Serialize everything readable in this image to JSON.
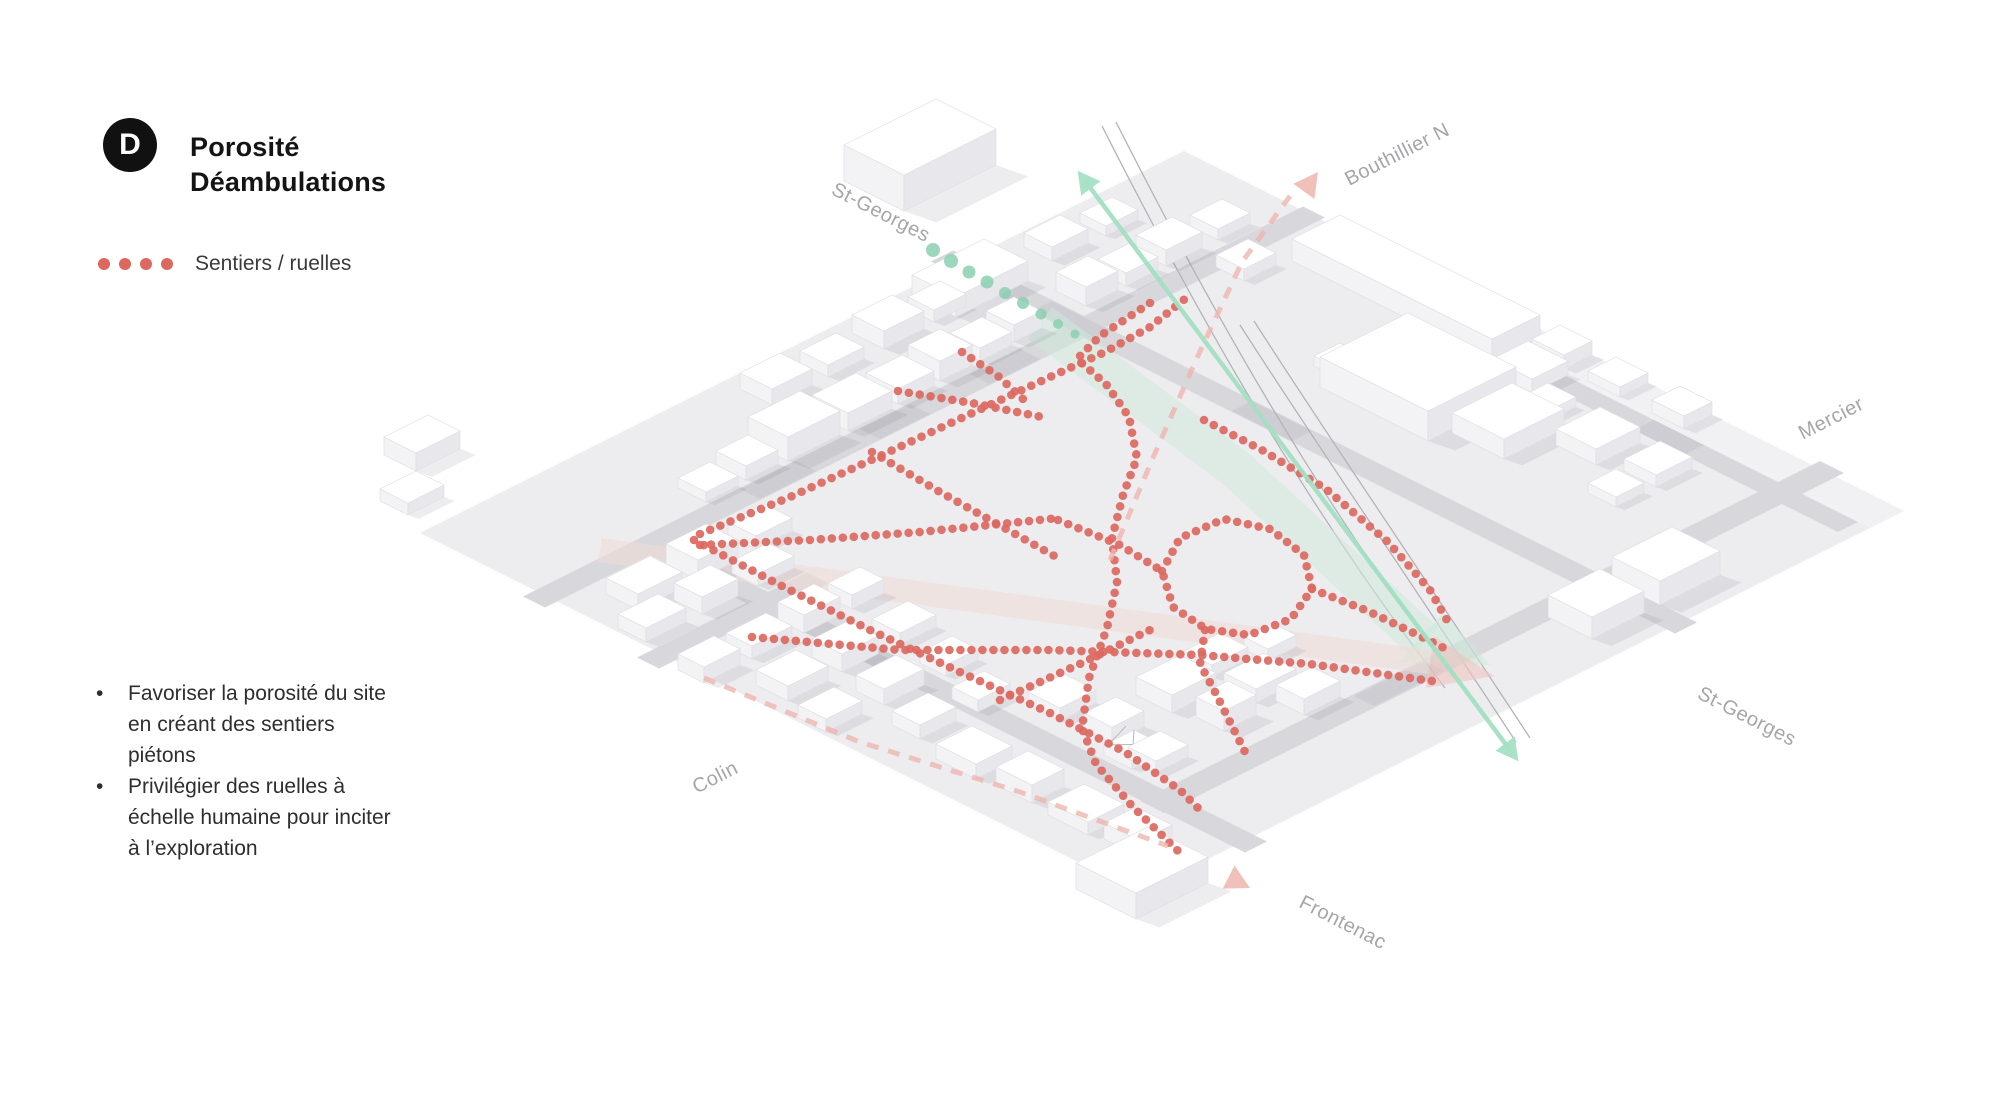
{
  "title": {
    "badge": "D",
    "line1": "Porosité",
    "line2": "Déambulations"
  },
  "legend": {
    "label": "Sentiers / ruelles",
    "dot_color": "#dc685f"
  },
  "notes": [
    "Favoriser la porosité du site en créant des sentiers piétons",
    "Privilégier des ruelles à échelle humaine pour inciter à l’exploration"
  ],
  "map": {
    "colors": {
      "plate": "#ededf0",
      "plate_east": "#f1f1f4",
      "street": "#d8d8dc",
      "street_patch": "#c2c2c9",
      "bldg_top": "#ffffff",
      "bldg_left": "#f3f3f6",
      "bldg_right": "#e7e7ec",
      "bldg_stroke": "#dddde2",
      "shadow": "rgba(80,80,95,0.10)",
      "rail": "#b3b3b8",
      "red": "#dc685f",
      "teal": "#8bcfb1",
      "green_arrow": "#a4e0c3",
      "mint_band": "#cfe9da",
      "pink_band": "#f2dcd8",
      "pink_head": "#eec4bf",
      "pink_dash": "#efb5af",
      "label": "#a6a6aa",
      "kiosk_line": "#b0b0b6"
    },
    "plate": [
      [
        -2,
        -2
      ],
      [
        380,
        -2
      ],
      [
        380,
        358
      ],
      [
        -2,
        358
      ]
    ],
    "plate_east": [
      [
        363,
        142
      ],
      [
        380,
        142
      ],
      [
        380,
        358
      ],
      [
        363,
        358
      ]
    ],
    "streets": [
      {
        "name": "bouthillier-n",
        "type": "e1",
        "v": 61,
        "u0": -8,
        "u1": 382,
        "hw": 5.5
      },
      {
        "name": "colin",
        "type": "e1",
        "v": 120,
        "u0": -10,
        "u1": 75,
        "hw": 5.5
      },
      {
        "name": "mercier",
        "type": "e1",
        "v": 318,
        "u0": 44,
        "u1": 384,
        "hw": 6
      },
      {
        "name": "st-georges",
        "type": "e2",
        "u": 267,
        "v0": -10,
        "v1": 362,
        "hw": 5.5
      },
      {
        "name": "frontenac",
        "type": "e2",
        "u": 50,
        "v0": 58,
        "v1": 364,
        "hw": 5.5
      },
      {
        "name": "right-edge-street",
        "type": "e2",
        "u": 358,
        "v0": 138,
        "v1": 352,
        "hw": 5
      }
    ],
    "street_patches": [
      {
        "type": "e1",
        "v": 61,
        "u0": 100,
        "u1": 128,
        "hw": 5
      },
      {
        "type": "e1",
        "v": 61,
        "u0": 160,
        "u1": 185,
        "hw": 5
      },
      {
        "type": "e1",
        "v": 61,
        "u0": 215,
        "u1": 240,
        "hw": 5
      },
      {
        "type": "e2",
        "u": 267,
        "v0": 40,
        "v1": 70,
        "hw": 5
      },
      {
        "type": "e2",
        "u": 267,
        "v0": 140,
        "v1": 170,
        "hw": 5
      },
      {
        "type": "e2",
        "u": 50,
        "v0": 150,
        "v1": 180,
        "hw": 5
      },
      {
        "type": "e1",
        "v": 318,
        "u0": 150,
        "u1": 185,
        "hw": 5
      },
      {
        "type": "e2",
        "u": 358,
        "v0": 150,
        "v1": 185,
        "hw": 5
      },
      {
        "type": "e2",
        "u": 358,
        "v0": 250,
        "v1": 275,
        "hw": 5
      }
    ],
    "rails": [
      "M1102,126 C1190,300 1300,500 1445,688",
      "M1116,122 C1204,296 1314,496 1459,684",
      "M1240,325 C1320,450 1410,580 1516,742",
      "M1254,321 C1334,446 1424,576 1530,738"
    ],
    "buildings": [
      [
        280,
        -72,
        46,
        30,
        36
      ],
      [
        240,
        2,
        36,
        22,
        20
      ],
      [
        28,
        -50,
        22,
        16,
        18
      ],
      [
        4,
        -28,
        18,
        14,
        12
      ],
      [
        150,
        6,
        20,
        16,
        16
      ],
      [
        178,
        8,
        18,
        14,
        12
      ],
      [
        206,
        6,
        20,
        16,
        18
      ],
      [
        232,
        8,
        16,
        13,
        12
      ],
      [
        292,
        6,
        18,
        14,
        14
      ],
      [
        318,
        8,
        16,
        13,
        10
      ],
      [
        85,
        40,
        16,
        14,
        10
      ],
      [
        106,
        38,
        16,
        15,
        14
      ],
      [
        126,
        34,
        26,
        20,
        24
      ],
      [
        156,
        36,
        22,
        18,
        18
      ],
      [
        182,
        37,
        18,
        16,
        15
      ],
      [
        204,
        36,
        16,
        16,
        20
      ],
      [
        224,
        37,
        16,
        15,
        13
      ],
      [
        242,
        37,
        14,
        14,
        17
      ],
      [
        278,
        36,
        16,
        15,
        19
      ],
      [
        298,
        37,
        16,
        14,
        13
      ],
      [
        318,
        36,
        18,
        15,
        16
      ],
      [
        344,
        37,
        16,
        14,
        11
      ],
      [
        14,
        75,
        22,
        16,
        16
      ],
      [
        44,
        75,
        20,
        16,
        20
      ],
      [
        74,
        76,
        18,
        14,
        13
      ],
      [
        0,
        95,
        20,
        14,
        14
      ],
      [
        28,
        95,
        18,
        14,
        17
      ],
      [
        56,
        96,
        18,
        13,
        12
      ],
      [
        -6,
        131,
        18,
        13,
        16
      ],
      [
        18,
        131,
        20,
        13,
        13
      ],
      [
        44,
        131,
        18,
        13,
        18
      ],
      [
        68,
        132,
        16,
        12,
        14
      ],
      [
        6,
        158,
        20,
        16,
        15
      ],
      [
        34,
        158,
        18,
        15,
        18
      ],
      [
        62,
        160,
        18,
        14,
        12
      ],
      [
        0,
        185,
        18,
        14,
        13
      ],
      [
        28,
        186,
        20,
        14,
        16
      ],
      [
        58,
        188,
        16,
        13,
        11
      ],
      [
        20,
        212,
        18,
        14,
        14
      ],
      [
        48,
        214,
        16,
        13,
        12
      ],
      [
        14,
        240,
        18,
        20,
        15
      ],
      [
        16,
        268,
        16,
        18,
        18
      ],
      [
        14,
        296,
        18,
        20,
        13
      ],
      [
        16,
        322,
        16,
        18,
        16
      ],
      [
        64,
        236,
        18,
        16,
        13
      ],
      [
        66,
        262,
        16,
        14,
        16
      ],
      [
        62,
        288,
        16,
        14,
        12
      ],
      [
        96,
        258,
        22,
        18,
        18
      ],
      [
        124,
        254,
        18,
        14,
        12
      ],
      [
        100,
        284,
        16,
        14,
        20
      ],
      [
        122,
        276,
        20,
        16,
        14
      ],
      [
        128,
        296,
        18,
        14,
        16
      ],
      [
        146,
        262,
        14,
        12,
        12
      ],
      [
        -16,
        340,
        36,
        30,
        26
      ],
      [
        352,
        80,
        24,
        100,
        22
      ],
      [
        346,
        186,
        18,
        20,
        14
      ],
      [
        330,
        64,
        16,
        14,
        12
      ],
      [
        305,
        138,
        13,
        12,
        10
      ],
      [
        307,
        156,
        13,
        12,
        12
      ],
      [
        309,
        174,
        12,
        11,
        9
      ],
      [
        296,
        150,
        44,
        54,
        30
      ],
      [
        306,
        206,
        30,
        26,
        20
      ],
      [
        336,
        210,
        14,
        14,
        10
      ],
      [
        366,
        186,
        14,
        16,
        14
      ],
      [
        366,
        214,
        14,
        16,
        10
      ],
      [
        366,
        246,
        14,
        16,
        13
      ],
      [
        326,
        238,
        22,
        20,
        16
      ],
      [
        330,
        268,
        18,
        16,
        12
      ],
      [
        310,
        270,
        14,
        14,
        10
      ],
      [
        238,
        322,
        26,
        22,
        22
      ],
      [
        272,
        320,
        30,
        24,
        24
      ]
    ],
    "kiosk": [
      58,
      280,
      15,
      14,
      10
    ],
    "red_paths": [
      [
        [
          700,
          534
        ],
        [
          790,
          497
        ],
        [
          880,
          456
        ],
        [
          968,
          415
        ],
        [
          1050,
          377
        ],
        [
          1105,
          352
        ],
        [
          1150,
          327
        ],
        [
          1186,
          298
        ]
      ],
      [
        [
          694,
          540
        ],
        [
          780,
          585
        ],
        [
          870,
          630
        ],
        [
          960,
          672
        ],
        [
          1050,
          713
        ],
        [
          1125,
          752
        ],
        [
          1180,
          790
        ],
        [
          1200,
          810
        ]
      ],
      [
        [
          752,
          637
        ],
        [
          900,
          650
        ],
        [
          1050,
          650
        ],
        [
          1200,
          655
        ],
        [
          1310,
          664
        ],
        [
          1432,
          681
        ]
      ],
      [
        [
          700,
          545
        ],
        [
          810,
          540
        ],
        [
          920,
          532
        ],
        [
          1020,
          522
        ],
        [
          1058,
          518
        ]
      ],
      [
        [
          1150,
          303
        ],
        [
          1100,
          336
        ],
        [
          1077,
          359
        ],
        [
          1106,
          384
        ],
        [
          1129,
          417
        ],
        [
          1137,
          458
        ],
        [
          1123,
          495
        ],
        [
          1112,
          538
        ],
        [
          1117,
          582
        ],
        [
          1107,
          628
        ],
        [
          1089,
          678
        ],
        [
          1082,
          728
        ],
        [
          1096,
          764
        ],
        [
          1132,
          806
        ],
        [
          1178,
          851
        ]
      ],
      [
        [
          872,
          452
        ],
        [
          940,
          492
        ],
        [
          1008,
          530
        ],
        [
          1058,
          558
        ]
      ],
      [
        [
          1162,
          571
        ],
        [
          1180,
          538
        ],
        [
          1224,
          519
        ],
        [
          1270,
          529
        ],
        [
          1304,
          555
        ],
        [
          1312,
          589
        ],
        [
          1291,
          619
        ],
        [
          1249,
          635
        ],
        [
          1206,
          629
        ],
        [
          1173,
          607
        ],
        [
          1162,
          571
        ]
      ],
      [
        [
          1058,
          520
        ],
        [
          1120,
          545
        ],
        [
          1162,
          571
        ]
      ],
      [
        [
          1312,
          589
        ],
        [
          1368,
          611
        ],
        [
          1420,
          636
        ],
        [
          1452,
          652
        ]
      ],
      [
        [
          1000,
          700
        ],
        [
          1082,
          663
        ],
        [
          1158,
          626
        ]
      ],
      [
        [
          898,
          391
        ],
        [
          972,
          403
        ],
        [
          1042,
          417
        ]
      ],
      [
        [
          962,
          352
        ],
        [
          998,
          376
        ],
        [
          1024,
          400
        ]
      ],
      [
        [
          1204,
          420
        ],
        [
          1262,
          450
        ],
        [
          1326,
          489
        ],
        [
          1388,
          542
        ],
        [
          1430,
          590
        ],
        [
          1448,
          622
        ]
      ],
      [
        [
          1205,
          630
        ],
        [
          1200,
          664
        ],
        [
          1214,
          690
        ],
        [
          1230,
          722
        ],
        [
          1247,
          756
        ]
      ]
    ],
    "teal_dots": [
      [
        933,
        250,
        7
      ],
      [
        951,
        261,
        7
      ],
      [
        969,
        272,
        6.5
      ],
      [
        987,
        282,
        6.5
      ],
      [
        1005,
        293,
        6
      ],
      [
        1023,
        303,
        6
      ],
      [
        1041,
        314,
        5.5
      ],
      [
        1058,
        324,
        5
      ],
      [
        1075,
        334,
        4.5
      ]
    ],
    "green_arrow": {
      "x1": 1086,
      "y1": 182,
      "x2": 1510,
      "y2": 750
    },
    "mint_band": {
      "path": "M1040,323 L1235,468 L1425,642",
      "width": 40,
      "head": [
        [
          1490,
          665
        ],
        [
          1397,
          663
        ],
        [
          1443,
          613
        ]
      ]
    },
    "pink_band": {
      "x1": 600,
      "y1": 550,
      "x2": 1430,
      "y2": 662,
      "width": 24,
      "head": [
        [
          1494,
          676
        ],
        [
          1426,
          688
        ],
        [
          1434,
          636
        ]
      ]
    },
    "pink_dashes": [
      {
        "path": "M1110,560 L1152,460 L1196,360 L1242,262 L1290,196",
        "tip": [
          1318,
          172
        ],
        "angle": -54
      },
      {
        "path": "M704,678 L860,742 L1020,792 L1168,846",
        "tip": [
          1250,
          888
        ],
        "angle": 27
      }
    ],
    "labels": [
      {
        "id": "st-georges-top",
        "text": "St-Georges",
        "x": 878,
        "y": 218,
        "rot": 27
      },
      {
        "id": "bouthillier-n",
        "text": "Bouthillier N",
        "x": 1400,
        "y": 160,
        "rot": -27
      },
      {
        "id": "mercier",
        "text": "Mercier",
        "x": 1834,
        "y": 424,
        "rot": -27
      },
      {
        "id": "st-georges-bottom",
        "text": "St-Georges",
        "x": 1744,
        "y": 722,
        "rot": 27
      },
      {
        "id": "frontenac",
        "text": "Frontenac",
        "x": 1340,
        "y": 928,
        "rot": 27
      },
      {
        "id": "colin",
        "text": "Colin",
        "x": 718,
        "y": 783,
        "rot": -27
      }
    ]
  }
}
